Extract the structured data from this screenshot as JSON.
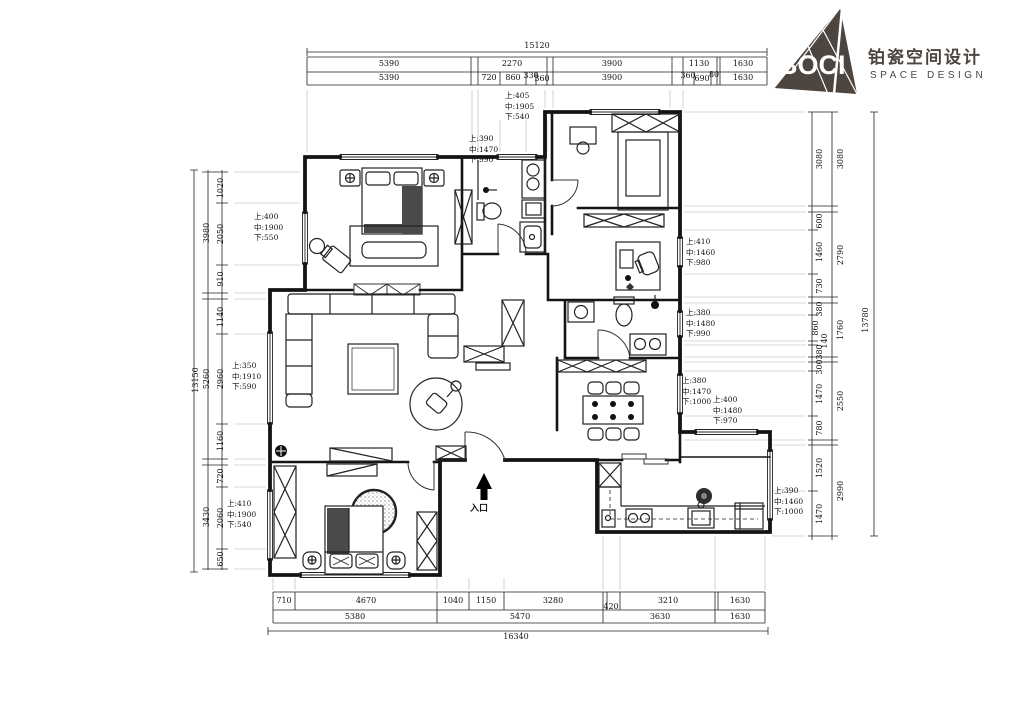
{
  "logo": {
    "brand": "BOCI",
    "brand_cn": "铂瓷空间设计",
    "brand_en": "SPACE DESIGN"
  },
  "colors": {
    "ink": "#141414",
    "logo": "#4d4540"
  },
  "plan": {
    "entry_label": "入口",
    "annotations": [
      {
        "lines": [
          "上:405",
          "中:1905",
          "下:540"
        ],
        "x": 505,
        "y": 91
      },
      {
        "lines": [
          "上:390",
          "中:1470",
          "下:990"
        ],
        "x": 469,
        "y": 134
      },
      {
        "lines": [
          "上:400",
          "中:1900",
          "下:550"
        ],
        "x": 254,
        "y": 212
      },
      {
        "lines": [
          "上:410",
          "中:1460",
          "下:980"
        ],
        "x": 686,
        "y": 237
      },
      {
        "lines": [
          "上:380",
          "中:1480",
          "下:990"
        ],
        "x": 686,
        "y": 308
      },
      {
        "lines": [
          "上:380",
          "中:1470",
          "下:1000"
        ],
        "x": 682,
        "y": 376
      },
      {
        "lines": [
          "上:400",
          "中:1480",
          "下:970"
        ],
        "x": 713,
        "y": 395
      },
      {
        "lines": [
          "上:350",
          "中:1910",
          "下:590"
        ],
        "x": 232,
        "y": 361
      },
      {
        "lines": [
          "上:410",
          "中:1900",
          "下:540"
        ],
        "x": 227,
        "y": 499
      },
      {
        "lines": [
          "上:390",
          "中:1460",
          "下:1000"
        ],
        "x": 774,
        "y": 486
      }
    ],
    "dim_labels": [
      {
        "t": "15120",
        "x": 537,
        "y": 46
      },
      {
        "t": "5390",
        "x": 389,
        "y": 64
      },
      {
        "t": "2270",
        "x": 512,
        "y": 64
      },
      {
        "t": "3900",
        "x": 612,
        "y": 64
      },
      {
        "t": "1130",
        "x": 699,
        "y": 64
      },
      {
        "t": "1630",
        "x": 743,
        "y": 64
      },
      {
        "t": "5390",
        "x": 389,
        "y": 78
      },
      {
        "t": "720",
        "x": 489,
        "y": 78
      },
      {
        "t": "860",
        "x": 513,
        "y": 78
      },
      {
        "t": "330",
        "x": 531,
        "y": 76
      },
      {
        "t": "360",
        "x": 542,
        "y": 79
      },
      {
        "t": "3900",
        "x": 612,
        "y": 78
      },
      {
        "t": "360",
        "x": 688,
        "y": 76
      },
      {
        "t": "690",
        "x": 702,
        "y": 79
      },
      {
        "t": "80",
        "x": 714,
        "y": 75
      },
      {
        "t": "1630",
        "x": 743,
        "y": 78
      },
      {
        "t": "710",
        "x": 284,
        "y": 601
      },
      {
        "t": "4670",
        "x": 366,
        "y": 601
      },
      {
        "t": "1040",
        "x": 453,
        "y": 601
      },
      {
        "t": "1150",
        "x": 486,
        "y": 601
      },
      {
        "t": "3280",
        "x": 553,
        "y": 601
      },
      {
        "t": "420",
        "x": 611,
        "y": 607
      },
      {
        "t": "3210",
        "x": 668,
        "y": 601
      },
      {
        "t": "1630",
        "x": 740,
        "y": 601
      },
      {
        "t": "5380",
        "x": 355,
        "y": 617
      },
      {
        "t": "5470",
        "x": 520,
        "y": 617
      },
      {
        "t": "3630",
        "x": 660,
        "y": 617
      },
      {
        "t": "1630",
        "x": 740,
        "y": 617
      },
      {
        "t": "16340",
        "x": 516,
        "y": 637
      },
      {
        "t": "13150",
        "x": 196,
        "y": 380,
        "r": true
      },
      {
        "t": "3980",
        "x": 207,
        "y": 233,
        "r": true
      },
      {
        "t": "5260",
        "x": 207,
        "y": 379,
        "r": true
      },
      {
        "t": "3430",
        "x": 207,
        "y": 517,
        "r": true
      },
      {
        "t": "1020",
        "x": 221,
        "y": 188,
        "r": true
      },
      {
        "t": "2050",
        "x": 221,
        "y": 234,
        "r": true
      },
      {
        "t": "910",
        "x": 221,
        "y": 279,
        "r": true
      },
      {
        "t": "1140",
        "x": 221,
        "y": 317,
        "r": true
      },
      {
        "t": "2960",
        "x": 221,
        "y": 379,
        "r": true
      },
      {
        "t": "1160",
        "x": 221,
        "y": 441,
        "r": true
      },
      {
        "t": "720",
        "x": 221,
        "y": 476,
        "r": true
      },
      {
        "t": "2060",
        "x": 221,
        "y": 518,
        "r": true
      },
      {
        "t": "650",
        "x": 221,
        "y": 559,
        "r": true
      },
      {
        "t": "3080",
        "x": 820,
        "y": 159,
        "r": true
      },
      {
        "t": "3080",
        "x": 841,
        "y": 159,
        "r": true
      },
      {
        "t": "600",
        "x": 820,
        "y": 221,
        "r": true
      },
      {
        "t": "1460",
        "x": 820,
        "y": 252,
        "r": true
      },
      {
        "t": "730",
        "x": 820,
        "y": 286,
        "r": true
      },
      {
        "t": "2790",
        "x": 841,
        "y": 255,
        "r": true
      },
      {
        "t": "380",
        "x": 820,
        "y": 309,
        "r": true
      },
      {
        "t": "860",
        "x": 816,
        "y": 328,
        "r": true
      },
      {
        "t": "140",
        "x": 825,
        "y": 341,
        "r": true
      },
      {
        "t": "380",
        "x": 820,
        "y": 352,
        "r": true
      },
      {
        "t": "1760",
        "x": 841,
        "y": 330,
        "r": true
      },
      {
        "t": "300",
        "x": 820,
        "y": 367,
        "r": true
      },
      {
        "t": "1470",
        "x": 820,
        "y": 394,
        "r": true
      },
      {
        "t": "780",
        "x": 820,
        "y": 428,
        "r": true
      },
      {
        "t": "2550",
        "x": 841,
        "y": 401,
        "r": true
      },
      {
        "t": "1520",
        "x": 820,
        "y": 468,
        "r": true
      },
      {
        "t": "1470",
        "x": 820,
        "y": 514,
        "r": true
      },
      {
        "t": "2990",
        "x": 841,
        "y": 491,
        "r": true
      },
      {
        "t": "13780",
        "x": 866,
        "y": 320,
        "r": true
      }
    ]
  }
}
